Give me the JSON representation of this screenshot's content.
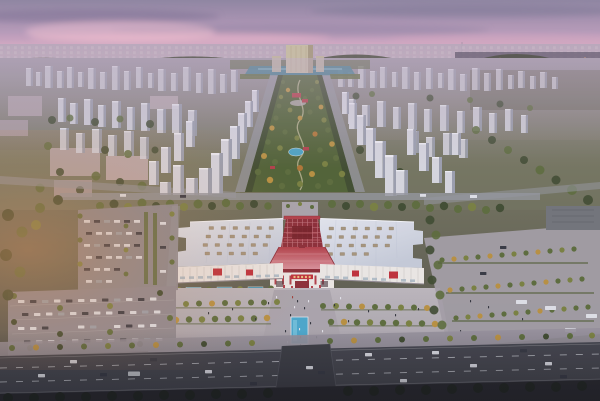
{
  "colors": {
    "sky_top": "#8e86a2",
    "sky_mid": "#b79cba",
    "sky_pink": "#e2b2c8",
    "sky_pink2": "#e6c0ce",
    "sky_horizon": "#d7c7d5",
    "cloud_dark": "#7b7093",
    "cloud_pink": "#e9b5c9",
    "haze_city": "#b5aabc",
    "suburb_dark": "#665e70",
    "far_treeline": "#4b5040",
    "ground_haze": "#9b95a0",
    "ground_mid": "#75765f",
    "ground_dark": "#4a4c46",
    "tower_light": "#d6d8e0",
    "tower_side": "#9aa0ae",
    "warehouse_pink": "#b7a8aa",
    "tree_dark": "#3c4a2e",
    "tree_green": "#5a6c3a",
    "tree_olive": "#78813f",
    "tree_autumn": "#b8913f",
    "tree_orange": "#b07634",
    "park_base": "#4f6234",
    "water_lake": "#3f7e8d",
    "pool_blue": "#49a8cc",
    "far_slab": "#c8bea6",
    "road_mid": "#94979e",
    "road_dark": "#42454d",
    "road_line": "#ccd0d6",
    "plaza_light": "#bcb8bd",
    "plaza_mid": "#a7a3aa",
    "roof_light": "#e3e7ef",
    "roof_mid": "#c6cdda",
    "skylight": "#a6967c",
    "facade_white": "#edeae6",
    "facade_shadow": "#cfc9c5",
    "red_main": "#b23f48",
    "red_dark": "#8c2d36",
    "red_light": "#d9929a",
    "red_sign": "#bf2f38",
    "car_white": "#dfe2e8",
    "car_dark": "#343842",
    "glow_warm": "#d28c52",
    "haze_lavender": "#c3b2cc"
  }
}
